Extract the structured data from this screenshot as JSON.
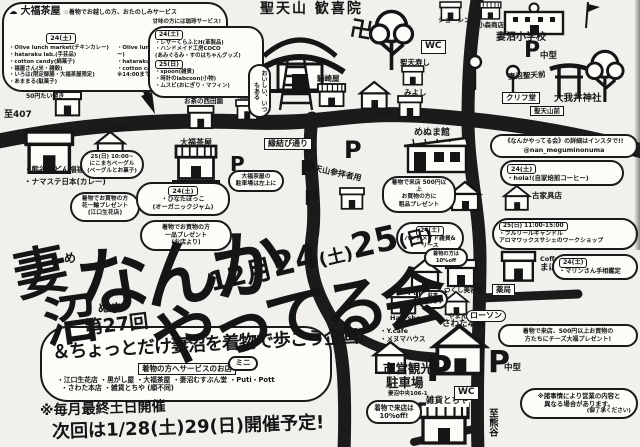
{
  "title": {
    "place1": "妻",
    "place2": "沼",
    "furi1": "め",
    "furi2": "ぬま",
    "main1": "なんか",
    "main2": "やってる会",
    "edition": "第27回",
    "date_month": "12月",
    "date_day1": "24",
    "date_wd1": "(土)",
    "date_day2": "25",
    "date_wd2": "(日)",
    "subtitle": "＆ちょっとだけ妻沼を着物で歩こう企画!",
    "mini": "ミニ"
  },
  "footer": {
    "service_box": "着物の方へサービスのお店",
    "service_list1": "・江口生花店 ・黒がし屋 ・大福茶屋 ・妻沼むすぶん堂 ・Puti・Pott",
    "service_list2": "・さわた本店 ・雑貨とちや (順不同)",
    "monthly": "※毎月最終土日開催",
    "next_time": "次回は1/28(土)29(日)開催予定!"
  },
  "daifuku": {
    "icon": "☁",
    "shop_name": "大福茶屋",
    "service1": "☆着物でお越しの方、おたのしみサービス",
    "service2": "甘味の方には珈琲サービス!",
    "day1": "24(土)",
    "day1_items": [
      "・Olive lunch market(チキンカレー)",
      "・hataraku lab.(手芸品)",
      "・cotton candy(綿菓子)",
      "・福屋さん(米・雑穀)",
      "・いろは(限定御膳・大福茶屋限定)",
      "・あままる(駄菓子)"
    ],
    "day2": "25(日)",
    "day2_items": [
      "・Olive lunch market(オリジナルカレー)",
      "・hataraku lab.(手芸品)",
      "・cotton candy(綿菓子)",
      "※14:00まで"
    ]
  },
  "stalls": {
    "day1": "24(土)",
    "day1_items": [
      "・レザーくらふとH(革製品)",
      "・ハンドメイド工房COCO",
      "(あみぐるみ・すのはちゃんグッズ)"
    ],
    "day2": "25(日)",
    "day2_items": [
      "・spoon(雑貨)",
      "・時計のlabcoon(小物)",
      "・ムスビ(おにぎり・マフィン)"
    ]
  },
  "bubbles": {
    "nicomachi": [
      "25(日) 10:00~",
      "にこまちベーグル",
      "(ベーグルとお菓子)"
    ],
    "flower": [
      "着物でお買物の方",
      "花一輪プレゼント",
      "(江口生花店)"
    ],
    "hinata": [
      "24(土)",
      "・ひなたぼっこ",
      "(オーガニックジャム)"
    ],
    "shop_gift": [
      "着物でお買物の方",
      "一品プレゼント",
      "(お店より)"
    ],
    "daifuku_p": [
      "大福茶屋の",
      "駐車場は左上に"
    ],
    "menuma_gift": [
      "着物で来店 500円以上",
      "お買物の方に",
      "粗品プレゼント"
    ],
    "insta": [
      "《なんかやってる会》の詳細はインスタで!!",
      "@nan_meguminonuma"
    ],
    "hola": [
      "24(土)",
      "・hola!(自家焙煎コーヒー)"
    ],
    "fleur": [
      "25(日) 11:00-15:00",
      "・フルリールキャンドル",
      "アロマワックスサシェのワークショップ"
    ],
    "marin": [
      "24(土)",
      "・マリンさん手相鑑定"
    ],
    "cheese": [
      "着物で来店、500円以上お買物の",
      "方たちにチーズ大福プレゼント!"
    ],
    "handmade": [
      "24(土)",
      "ハンドメイド雑貨&リース"
    ],
    "off10_small": [
      "着物の方は",
      "10%off"
    ],
    "yaman_p": [
      "駐車",
      "できます"
    ],
    "off10": [
      "着物で来店は",
      "10%off!"
    ],
    "notice": [
      "※諸事情により営業の内容と",
      "異なる場合があります。",
      "(御了承ください)"
    ],
    "vert": "おいしい、いつもある",
    "dots": "…"
  },
  "map": {
    "route407": "至407",
    "kumagaya": "至熊谷",
    "street": "縁結び通り",
    "temple": "聖天山 歓喜院",
    "manji": "卍",
    "wc": "WC",
    "school": "妻沼小学校",
    "p": "P",
    "p_mid": "中型",
    "bus_stop": "妻沼聖天前",
    "shrine": "大我井神社",
    "cliffdo": "クリフ堂",
    "temple_front": "聖天山前",
    "shoshin": "ショーシン",
    "komori": "小森商店",
    "kisakiya": "騎崎屋",
    "zushi": "聖天寿し",
    "miyoshi": "みよし",
    "hachidori": "ハチドリnote",
    "nishidaen": "お茶の西田園",
    "sakaya": "酒屋",
    "eguchi": "江口生花店",
    "fukufuku": "・熊谷うどん福福",
    "namaste": "・ナマステ日本(カレー)",
    "daifuku": "大福茶屋",
    "sanpai": "聖天山参拝者用",
    "menumakan": "めぬま館",
    "putipott": "Puti・Pott",
    "tsukushi": "つくし美容室",
    "hairshop": "Hair shop",
    "yaman": "やまん",
    "sawata": "さわた本店",
    "ycafe": "・Y.cafe",
    "mhouse": "・メヌマハウス",
    "city_p1": "市営観光",
    "city_p2": "駐車場",
    "city_note": "妻沼中央106-1",
    "tochiya": "雑貨とちや",
    "furukagu": "古家具店",
    "mahoroba1": "Coffee&Bar",
    "mahoroba2": "まほろば",
    "yakkyoku": "薬局",
    "lawson": "ローソン",
    "taiyaki": "50円たい焼き"
  }
}
